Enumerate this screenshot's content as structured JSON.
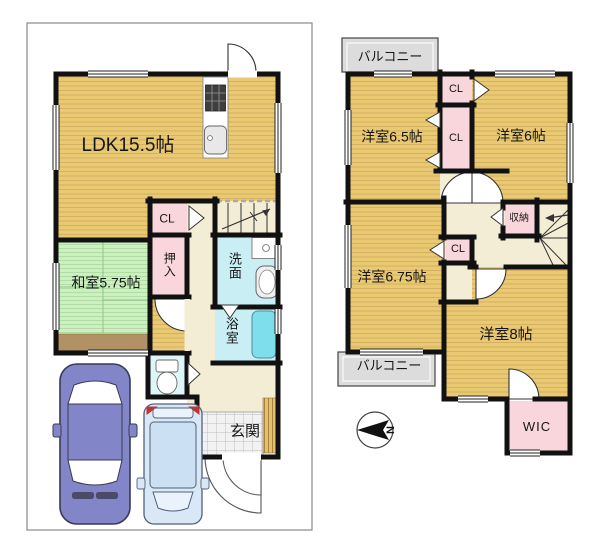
{
  "floor1": {
    "rooms": {
      "ldk": "LDK15.5帖",
      "washitsu": "和室5.75帖",
      "closet": "CL",
      "oshiire": "押入",
      "senmen": "洗面",
      "yokushitsu": "浴室",
      "genkan": "玄関"
    }
  },
  "floor2": {
    "rooms": {
      "balcony_top": "バルコニー",
      "room_65": "洋室6.5帖",
      "closet_top": "CL",
      "closet_mid": "CL",
      "room_6": "洋室6帖",
      "room_675": "洋室6.75帖",
      "closet_low": "CL",
      "shunou": "収納",
      "room_8": "洋室8帖",
      "balcony_bottom": "バルコニー",
      "wic": "WIC"
    }
  },
  "compass": {
    "north_label": "N"
  },
  "colors": {
    "wood_floor": "#E9C972",
    "tatami_green": "#CDEFC2",
    "closet_pink": "#F9D6DC",
    "wet_area_cyan": "#C9EFF4",
    "bathtub_cyan": "#7FDEEC",
    "hall_beige": "#F4EDD5",
    "balcony_gray": "#DCDCDC",
    "wall": "#111111",
    "car_sedan": "#8285C7",
    "car_minivan": "#D9E7F6"
  }
}
